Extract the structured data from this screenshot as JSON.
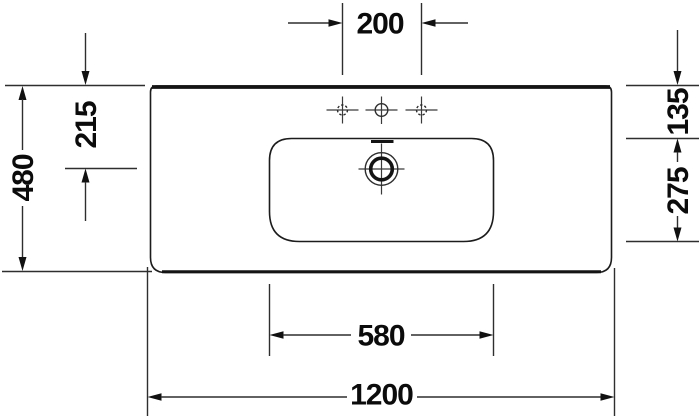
{
  "drawing": {
    "title": "washbasin-technical-drawing-top-view",
    "dimensions": {
      "tap_spacing": "200",
      "left_inner": "215",
      "left_overall": "480",
      "right_upper": "135",
      "right_lower": "275",
      "bowl_width": "580",
      "overall_width": "1200"
    },
    "symbols": {
      "tap_hole_outer": "dashed-circle-with-crosshair",
      "tap_hole_center": "solid-circle-with-crosshair",
      "drain": "concentric-circles-with-crosshair",
      "overflow": "thick-tick-mark"
    },
    "colors": {
      "background": "#ffffff",
      "line": "#2e2e2e",
      "outline": "#141414",
      "text": "#0b0b0b"
    }
  }
}
